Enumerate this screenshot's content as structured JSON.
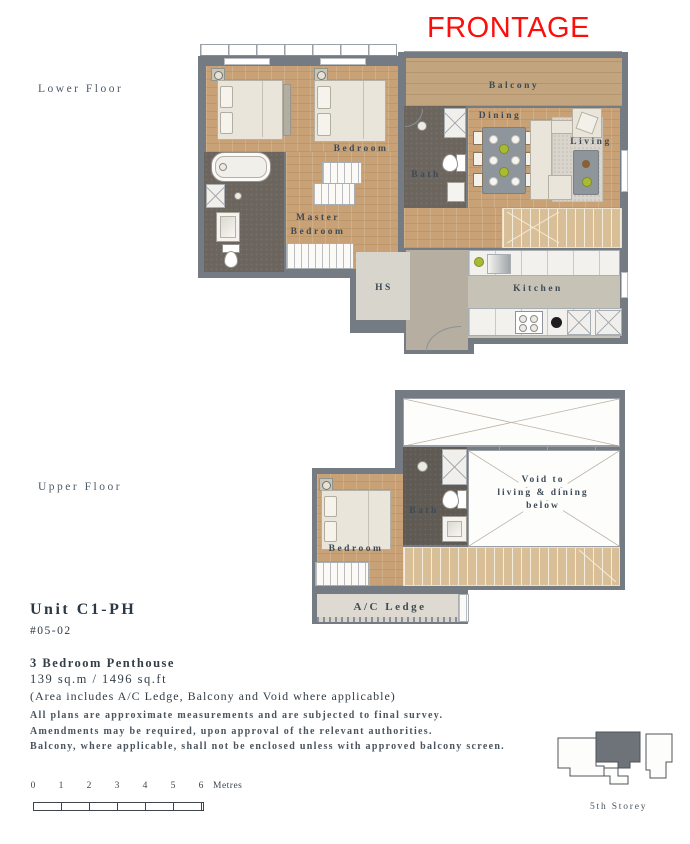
{
  "frontage_label": "FRONTAGE",
  "colors": {
    "frontage_red": "#fa0f0c",
    "wall_gray": "#747b83",
    "wood_floor": "#c8a276",
    "label_ink": "#3e4a55",
    "site_highlight": "#6d7379"
  },
  "floors": {
    "lower": {
      "label": "Lower Floor",
      "rooms": {
        "balcony": "Balcony",
        "dining": "Dining",
        "living": "Living",
        "bedroom": "Bedroom",
        "bath": "Bath",
        "master_line1": "Master",
        "master_line2": "Bedroom",
        "hs": "HS",
        "kitchen": "Kitchen"
      }
    },
    "upper": {
      "label": "Upper Floor",
      "rooms": {
        "bath": "Bath",
        "bedroom": "Bedroom",
        "void_line1": "Void to",
        "void_line2": "living & dining",
        "void_line3": "below",
        "ac_ledge": "A/C Ledge"
      }
    }
  },
  "unit": {
    "name": "Unit C1-PH",
    "number": "#05-02",
    "type": "3 Bedroom Penthouse",
    "area": "139 sq.m / 1496 sq.ft",
    "note": "(Area includes A/C Ledge, Balcony and Void where applicable)"
  },
  "disclaimer": [
    "All plans are approximate measurements and are subjected to final survey.",
    "Amendments may be required, upon approval of the relevant authorities.",
    "Balcony, where applicable, shall not be enclosed unless with approved balcony screen."
  ],
  "scale": {
    "ticks": [
      "0",
      "1",
      "2",
      "3",
      "4",
      "5",
      "6"
    ],
    "unit": "Metres"
  },
  "site_plan": {
    "storey": "5th Storey"
  }
}
